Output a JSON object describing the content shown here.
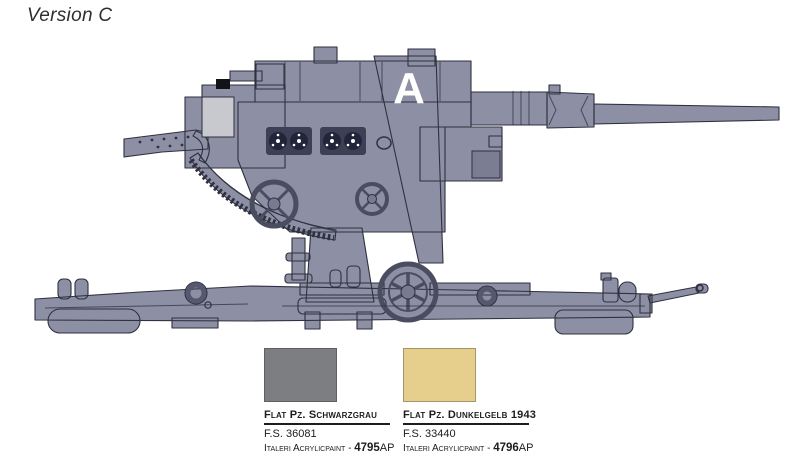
{
  "page": {
    "title": "Version C"
  },
  "colors": {
    "camo_gray": "#8d90a4",
    "camo_tan": "#ebdca1",
    "outline": "#2f3040",
    "panel_light": "#c8c9cf",
    "marking_white": "#ffffff",
    "swatch_gray": "#7d7e82",
    "swatch_tan": "#e6cf8c",
    "text": "#1d1d1d"
  },
  "illustration": {
    "subject": "88mm Flak gun side profile in two-tone camouflage",
    "marking_letter": "A"
  },
  "paints": [
    {
      "name": "Flat Pz. Schwarzgrau",
      "fs": "F.S. 36081",
      "brand": "Italeri Acrylicpaint -",
      "code": "4795",
      "code_suffix": "AP"
    },
    {
      "name": "Flat Pz. Dunkelgelb 1943",
      "fs": "F.S. 33440",
      "brand": "Italeri Acrylicpaint -",
      "code": "4796",
      "code_suffix": "AP"
    }
  ]
}
